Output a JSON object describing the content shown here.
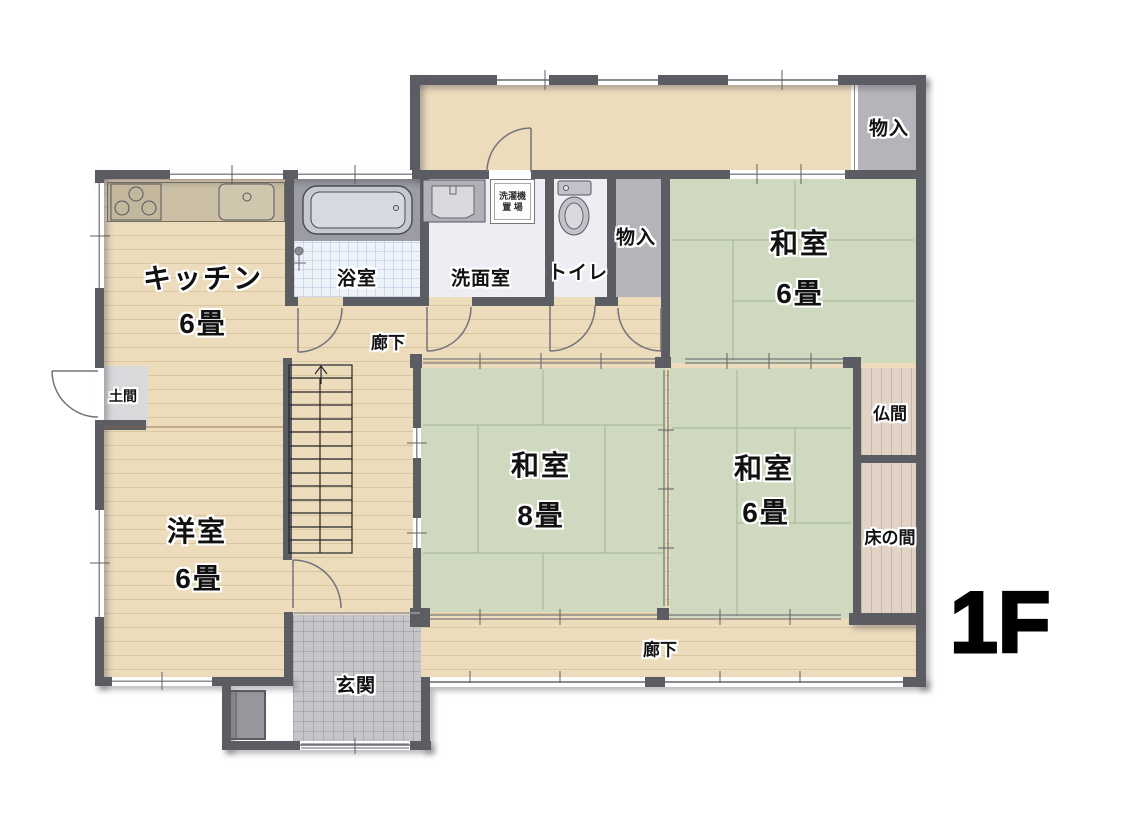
{
  "floor_plan": {
    "floor_label": "1F",
    "rooms": {
      "kitchen": {
        "name": "キッチン",
        "size": "6畳"
      },
      "western_room": {
        "name": "洋室",
        "size": "6畳"
      },
      "japanese_room_ne": {
        "name": "和室",
        "size": "6畳"
      },
      "japanese_room_center": {
        "name": "和室",
        "size": "8畳"
      },
      "japanese_room_se": {
        "name": "和室",
        "size": "6畳"
      },
      "bathroom": {
        "name": "浴室"
      },
      "washroom": {
        "name": "洗面室"
      },
      "toilet": {
        "name": "トイレ"
      },
      "closet_hall": {
        "name": "物入"
      },
      "closet_north": {
        "name": "物入"
      },
      "butsuma": {
        "name": "仏間"
      },
      "tokonoma": {
        "name": "床の間"
      },
      "hallway_upper": {
        "name": "廊下"
      },
      "hallway_lower": {
        "name": "廊下"
      },
      "entrance": {
        "name": "玄関"
      },
      "doma": {
        "name": "土間"
      },
      "laundry_space": {
        "name": "洗濯機置場",
        "line1": "洗濯機",
        "line2": "置 場"
      }
    },
    "colors": {
      "wall": "#5c5d63",
      "wood_floor": "#ecdcbc",
      "tatami": "#cfd9c0",
      "alcove_wood": "#e1d3c6",
      "closet_gray": "#b4b4ba",
      "entrance_tile": "#c6c6ca",
      "bath_tile": "#eef2f9",
      "wet_room_floor": "#ededf4",
      "doma_gray": "#d9d9dc",
      "kitchen_counter": "#cabfa4",
      "label_text": "#111111"
    }
  }
}
